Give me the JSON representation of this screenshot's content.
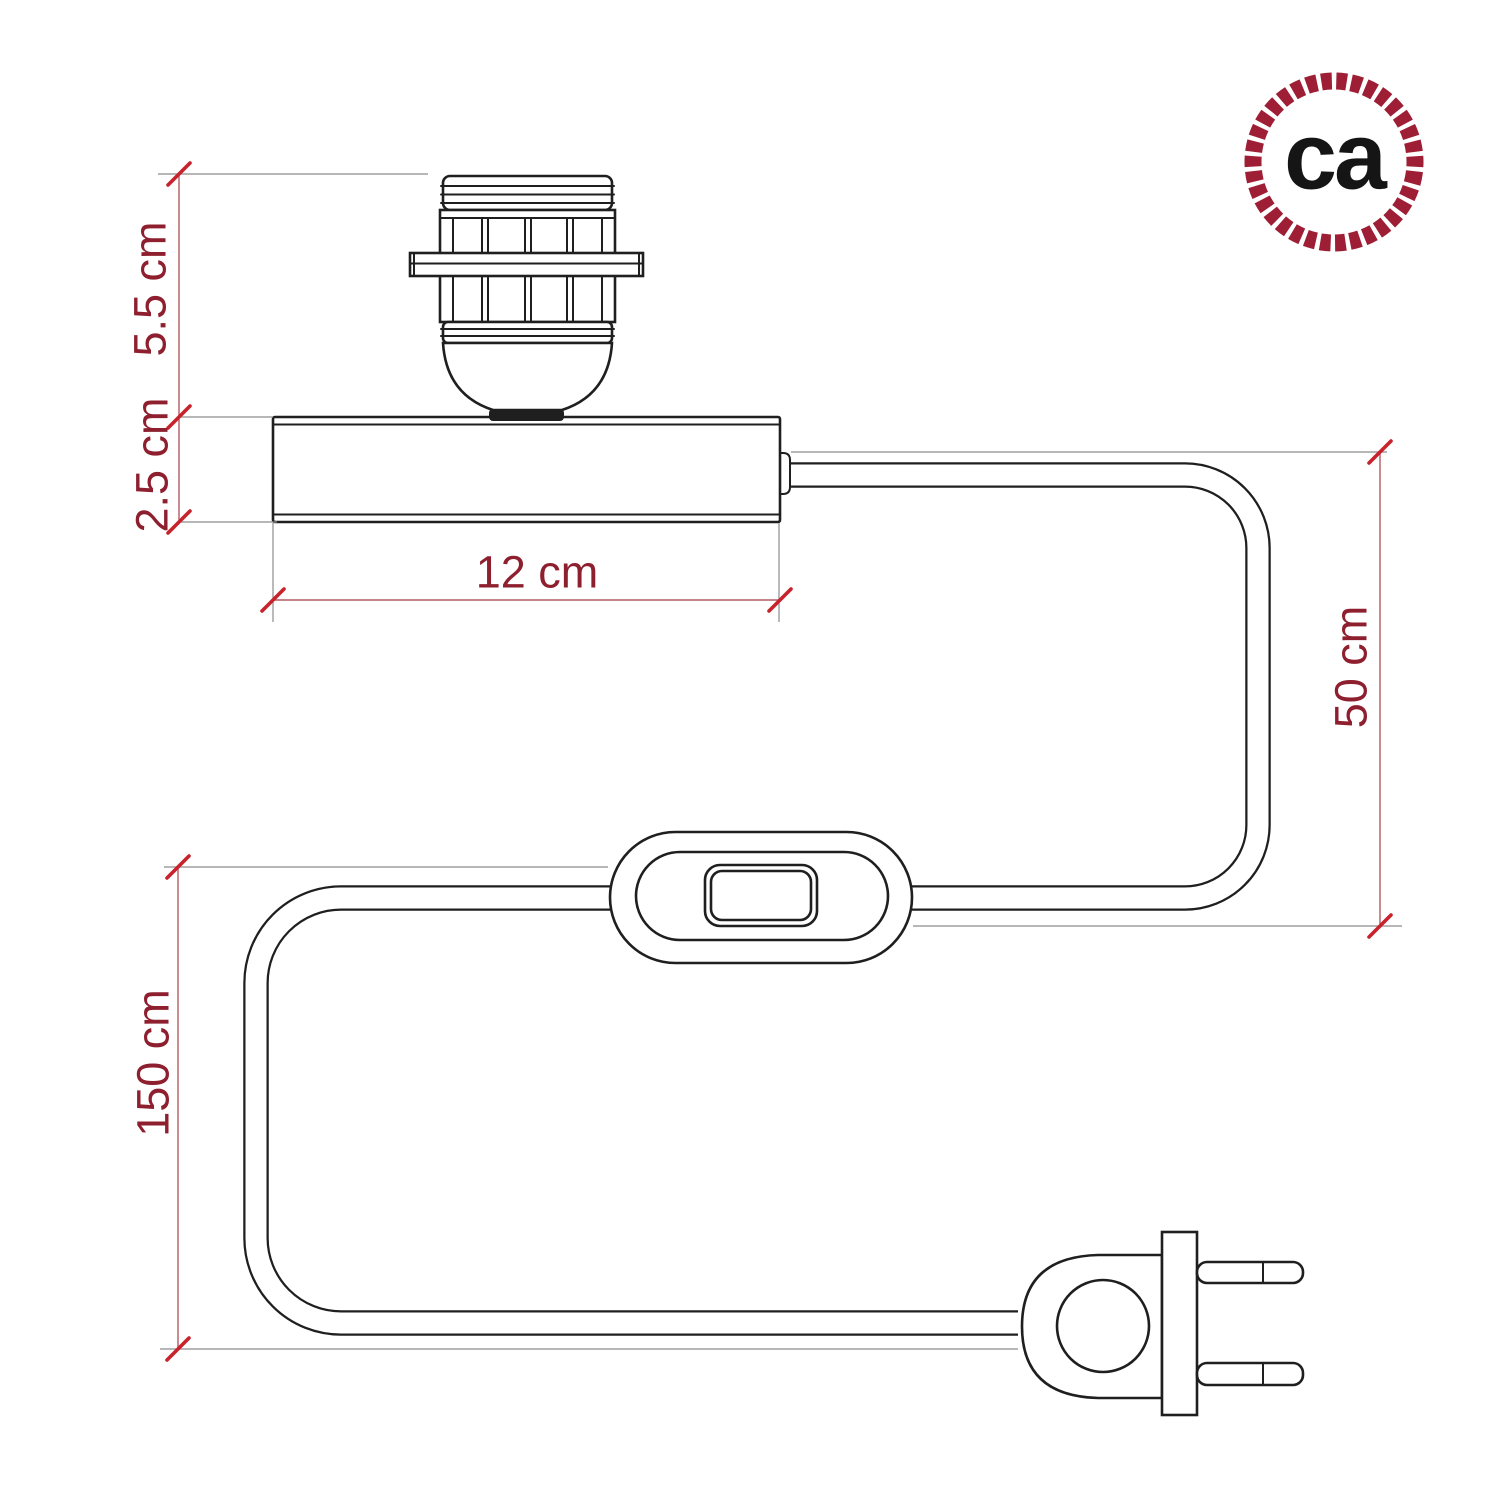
{
  "colors": {
    "paper": "#ffffff",
    "line": "#1f1f1f",
    "dimension_text": "#8e1f2e",
    "dimension_line": "#b25b62",
    "extension_line": "#8c8c8c",
    "tick": "#c8232c",
    "logo_rope": "#9e1f35",
    "logo_text": "#151515"
  },
  "logo": {
    "label": "ca"
  },
  "dimensions": {
    "socket_height": {
      "label": "5.5 cm"
    },
    "base_height": {
      "label": "2.5 cm"
    },
    "base_width": {
      "label": "12 cm"
    },
    "upper_cable_length": {
      "label": "50 cm"
    },
    "lower_cable_length": {
      "label": "150 cm"
    }
  },
  "diagram_parts": {
    "socket": "lamp-socket-for-shade",
    "base": "table-lamp-base",
    "cable": "power-cable",
    "switch": "inline-switch",
    "plug": "two-pin-plug"
  }
}
